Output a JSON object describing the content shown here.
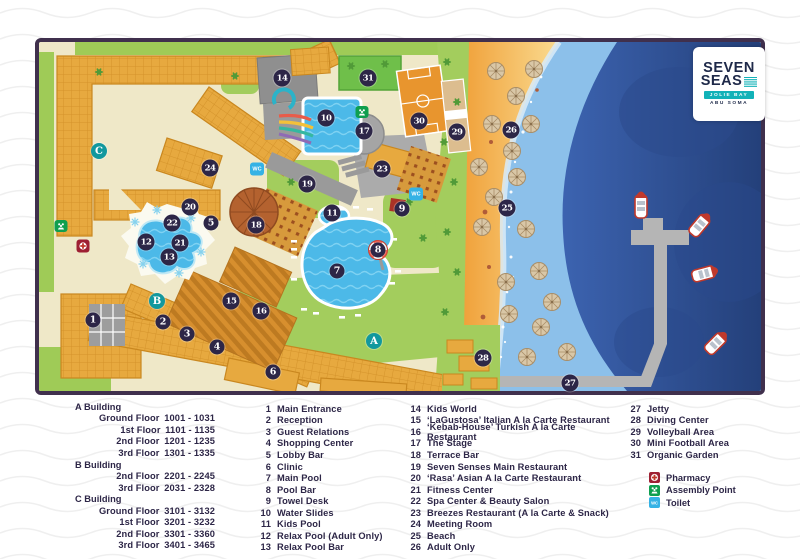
{
  "logo": {
    "line1": "SEVEN",
    "line2": "SEAS",
    "banner": "JOLIE BAY",
    "sub": "ABU SOMA"
  },
  "legend": {
    "buildings": [
      {
        "name": "A Building",
        "floors": [
          {
            "label": "Ground Floor",
            "range": "1001 - 1031"
          },
          {
            "label": "1st Floor",
            "range": "1101 - 1135"
          },
          {
            "label": "2nd Floor",
            "range": "1201 - 1235"
          },
          {
            "label": "3rd Floor",
            "range": "1301 - 1335"
          }
        ]
      },
      {
        "name": "B Building",
        "floors": [
          {
            "label": "2nd Floor",
            "range": "2201 - 2245"
          },
          {
            "label": "3rd Floor",
            "range": "2031 - 2328"
          }
        ]
      },
      {
        "name": "C Building",
        "floors": [
          {
            "label": "Ground Floor",
            "range": "3101 - 3132"
          },
          {
            "label": "1st Floor",
            "range": "3201 - 3232"
          },
          {
            "label": "2nd Floor",
            "range": "3301 - 3360"
          },
          {
            "label": "3rd Floor",
            "range": "3401 - 3465"
          }
        ]
      }
    ],
    "items_col1": [
      {
        "num": "1",
        "label": "Main Entrance"
      },
      {
        "num": "2",
        "label": "Reception"
      },
      {
        "num": "3",
        "label": "Guest Relations"
      },
      {
        "num": "4",
        "label": "Shopping Center"
      },
      {
        "num": "5",
        "label": "Lobby Bar"
      },
      {
        "num": "6",
        "label": "Clinic"
      },
      {
        "num": "7",
        "label": "Main Pool"
      },
      {
        "num": "8",
        "label": "Pool Bar"
      },
      {
        "num": "9",
        "label": "Towel Desk"
      },
      {
        "num": "10",
        "label": "Water Slides"
      },
      {
        "num": "11",
        "label": "Kids Pool"
      },
      {
        "num": "12",
        "label": "Relax Pool (Adult Only)"
      },
      {
        "num": "13",
        "label": "Relax Pool Bar"
      }
    ],
    "items_col2": [
      {
        "num": "14",
        "label": "Kids World"
      },
      {
        "num": "15",
        "label": "‘LaGustosa’ Italian A la Carte Restaurant"
      },
      {
        "num": "16",
        "label": "‘Kebab-House’ Turkish A la Carte Restaurant"
      },
      {
        "num": "17",
        "label": "The Stage"
      },
      {
        "num": "18",
        "label": "Terrace Bar"
      },
      {
        "num": "19",
        "label": "Seven Senses Main Restaurant"
      },
      {
        "num": "20",
        "label": "‘Rasa’ Asian A la Carte Restaurant"
      },
      {
        "num": "21",
        "label": "Fitness Center"
      },
      {
        "num": "22",
        "label": "Spa Center & Beauty Salon"
      },
      {
        "num": "23",
        "label": "Breezes Restaurant (A la Carte & Snack)"
      },
      {
        "num": "24",
        "label": "Meeting Room"
      },
      {
        "num": "25",
        "label": "Beach"
      },
      {
        "num": "26",
        "label": "Adult Only"
      }
    ],
    "items_col3": [
      {
        "num": "27",
        "label": "Jetty"
      },
      {
        "num": "28",
        "label": "Diving Center"
      },
      {
        "num": "29",
        "label": "Volleyball Area"
      },
      {
        "num": "30",
        "label": "Mini Football Area"
      },
      {
        "num": "31",
        "label": "Organic Garden"
      }
    ],
    "symbols": [
      {
        "icon": "pharmacy-icon",
        "label": "Pharmacy"
      },
      {
        "icon": "assembly-point-icon",
        "label": "Assembly Point"
      },
      {
        "icon": "toilet-icon",
        "label": "Toilet"
      }
    ]
  },
  "map": {
    "wc_label": "WC",
    "markers": [
      {
        "n": "1",
        "x": 54,
        "y": 278
      },
      {
        "n": "2",
        "x": 124,
        "y": 280
      },
      {
        "n": "3",
        "x": 148,
        "y": 292
      },
      {
        "n": "4",
        "x": 178,
        "y": 305
      },
      {
        "n": "5",
        "x": 172,
        "y": 181
      },
      {
        "n": "6",
        "x": 234,
        "y": 330
      },
      {
        "n": "7",
        "x": 298,
        "y": 229
      },
      {
        "n": "8",
        "x": 339,
        "y": 208
      },
      {
        "n": "9",
        "x": 363,
        "y": 167
      },
      {
        "n": "10",
        "x": 287,
        "y": 76
      },
      {
        "n": "11",
        "x": 293,
        "y": 171
      },
      {
        "n": "12",
        "x": 107,
        "y": 200
      },
      {
        "n": "13",
        "x": 130,
        "y": 215
      },
      {
        "n": "14",
        "x": 243,
        "y": 36
      },
      {
        "n": "15",
        "x": 192,
        "y": 259
      },
      {
        "n": "16",
        "x": 222,
        "y": 269
      },
      {
        "n": "17",
        "x": 325,
        "y": 89
      },
      {
        "n": "18",
        "x": 217,
        "y": 183
      },
      {
        "n": "19",
        "x": 268,
        "y": 142
      },
      {
        "n": "20",
        "x": 151,
        "y": 165
      },
      {
        "n": "21",
        "x": 141,
        "y": 201
      },
      {
        "n": "22",
        "x": 133,
        "y": 181
      },
      {
        "n": "23",
        "x": 343,
        "y": 127
      },
      {
        "n": "24",
        "x": 171,
        "y": 126
      },
      {
        "n": "25",
        "x": 468,
        "y": 166
      },
      {
        "n": "26",
        "x": 472,
        "y": 88
      },
      {
        "n": "27",
        "x": 531,
        "y": 341
      },
      {
        "n": "28",
        "x": 444,
        "y": 316
      },
      {
        "n": "29",
        "x": 418,
        "y": 90
      },
      {
        "n": "30",
        "x": 380,
        "y": 79
      },
      {
        "n": "31",
        "x": 329,
        "y": 36
      }
    ],
    "letters": [
      {
        "n": "A",
        "x": 335,
        "y": 299
      },
      {
        "n": "B",
        "x": 118,
        "y": 259
      },
      {
        "n": "C",
        "x": 60,
        "y": 109
      }
    ],
    "wc": [
      {
        "x": 218,
        "y": 127
      },
      {
        "x": 377,
        "y": 152
      }
    ],
    "assembly": [
      {
        "x": 22,
        "y": 184
      },
      {
        "x": 323,
        "y": 70
      }
    ],
    "pharmacy": [
      {
        "x": 44,
        "y": 204
      }
    ]
  },
  "colors": {
    "border": "#40304d",
    "navy": "#2d2647",
    "teal": "#12989e",
    "building": "#e7a93f",
    "pool": "#4cb9e8",
    "sea_deep": "#2a4787",
    "sea_shallow": "#8cc0ea",
    "sand": "#f0a13a",
    "green": "#a3cd5d",
    "wc_blue": "#35b2e5",
    "assembly_green": "#0f9f4f",
    "pharmacy_red": "#9e2033"
  }
}
